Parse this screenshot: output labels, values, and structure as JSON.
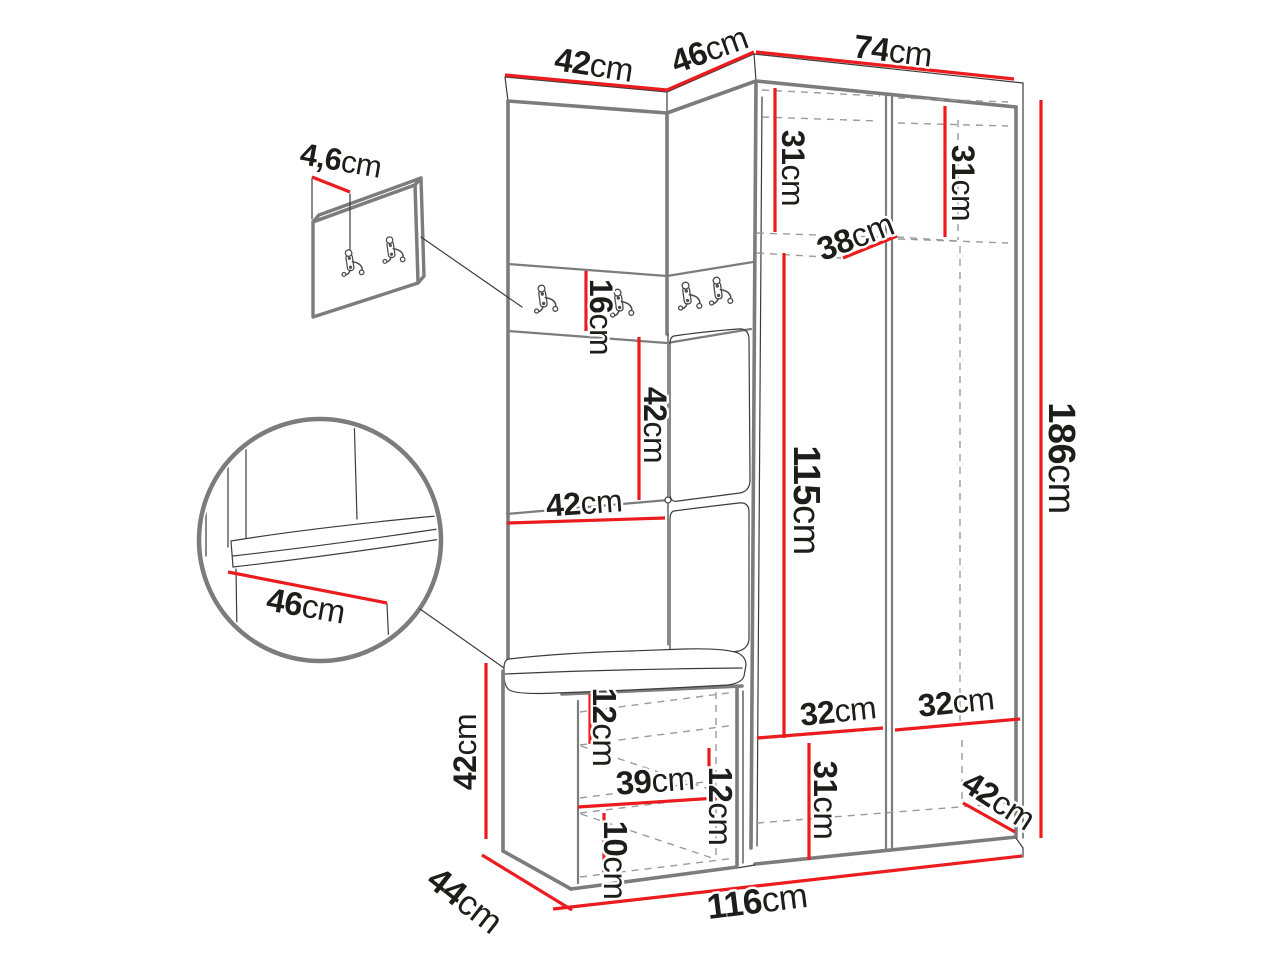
{
  "page": {
    "background": "#ffffff"
  },
  "diagram": {
    "kind": "furniture-dimension-drawing",
    "subject": "corner hallway wardrobe set with coat hooks, upholstered bench and wall hook panel",
    "unit": "cm",
    "colors": {
      "dimension": "#ec1b1e",
      "outline": "#7c7c7c",
      "detail": "#3c3c3c",
      "label": "#1d1d1b",
      "background": "#ffffff"
    },
    "dimensions": [
      {
        "id": "top-width-left",
        "value": "42",
        "unit": "cm",
        "line": {
          "x1": 505,
          "y1": 75,
          "x2": 667,
          "y2": 90
        },
        "label": {
          "x": 594,
          "y": 64,
          "rotate": 9,
          "size": 33
        }
      },
      {
        "id": "top-width-corner",
        "value": "46",
        "unit": "cm",
        "line": {
          "x1": 667,
          "y1": 90,
          "x2": 754,
          "y2": 52
        },
        "label": {
          "x": 709,
          "y": 49,
          "rotate": -20,
          "size": 33
        }
      },
      {
        "id": "top-width-right",
        "value": "74",
        "unit": "cm",
        "line": {
          "x1": 756,
          "y1": 52,
          "x2": 1014,
          "y2": 79
        },
        "label": {
          "x": 893,
          "y": 50,
          "rotate": 7,
          "size": 33
        }
      },
      {
        "id": "inner-height-top-left",
        "value": "31",
        "unit": "cm",
        "line": {
          "x1": 775,
          "y1": 88,
          "x2": 775,
          "y2": 232
        },
        "label": {
          "x": 793,
          "y": 168,
          "rotate": 90,
          "size": 32
        }
      },
      {
        "id": "inner-height-top-right",
        "value": "31",
        "unit": "cm",
        "line": {
          "x1": 945,
          "y1": 106,
          "x2": 945,
          "y2": 237
        },
        "label": {
          "x": 963,
          "y": 183,
          "rotate": 90,
          "size": 32
        }
      },
      {
        "id": "inner-depth-top",
        "value": "38",
        "unit": "cm",
        "line": {
          "x1": 843,
          "y1": 258,
          "x2": 897,
          "y2": 236
        },
        "label": {
          "x": 855,
          "y": 236,
          "rotate": -21,
          "size": 33
        }
      },
      {
        "id": "total-height",
        "value": "186",
        "unit": "cm",
        "line": {
          "x1": 1041,
          "y1": 100,
          "x2": 1041,
          "y2": 838
        },
        "label": {
          "x": 1061,
          "y": 458,
          "rotate": 90,
          "size": 38
        }
      },
      {
        "id": "hook-strip-height",
        "value": "16",
        "unit": "cm",
        "line": {
          "x1": 586,
          "y1": 271,
          "x2": 586,
          "y2": 331
        },
        "label": {
          "x": 601,
          "y": 317,
          "rotate": 90,
          "size": 32
        }
      },
      {
        "id": "niche-height",
        "value": "42",
        "unit": "cm",
        "line": {
          "x1": 639,
          "y1": 337,
          "x2": 639,
          "y2": 500
        },
        "label": {
          "x": 655,
          "y": 425,
          "rotate": 90,
          "size": 32
        }
      },
      {
        "id": "niche-width",
        "value": "42",
        "unit": "cm",
        "line": {
          "x1": 507,
          "y1": 523,
          "x2": 665,
          "y2": 518
        },
        "label": {
          "x": 584,
          "y": 503,
          "rotate": -4,
          "size": 32
        }
      },
      {
        "id": "tall-inner-height",
        "value": "115",
        "unit": "cm",
        "line": {
          "x1": 784,
          "y1": 253,
          "x2": 784,
          "y2": 738
        },
        "label": {
          "x": 806,
          "y": 500,
          "rotate": 90,
          "size": 38
        }
      },
      {
        "id": "seat-depth-detail",
        "value": "46",
        "unit": "cm",
        "line": {
          "x1": 228,
          "y1": 572,
          "x2": 387,
          "y2": 603
        },
        "label": {
          "x": 306,
          "y": 605,
          "rotate": 10,
          "size": 33
        }
      },
      {
        "id": "panel-depth",
        "value": "4,6",
        "unit": "cm",
        "line": {
          "x1": 312,
          "y1": 177,
          "x2": 350,
          "y2": 192
        },
        "label": {
          "x": 341,
          "y": 160,
          "rotate": 10,
          "size": 31
        }
      },
      {
        "id": "bench-height",
        "value": "42",
        "unit": "cm",
        "line": {
          "x1": 486,
          "y1": 663,
          "x2": 486,
          "y2": 839
        },
        "label": {
          "x": 465,
          "y": 752,
          "rotate": -90,
          "size": 32
        }
      },
      {
        "id": "bench-top-gap",
        "value": "12",
        "unit": "cm",
        "line": {
          "x1": 590,
          "y1": 694,
          "x2": 590,
          "y2": 744
        },
        "label": {
          "x": 605,
          "y": 727,
          "rotate": 90,
          "size": 33
        }
      },
      {
        "id": "bench-inner-width",
        "value": "39",
        "unit": "cm",
        "line": {
          "x1": 578,
          "y1": 807,
          "x2": 717,
          "y2": 798
        },
        "label": {
          "x": 655,
          "y": 780,
          "rotate": -4,
          "size": 33
        }
      },
      {
        "id": "bench-shelf-gap",
        "value": "12",
        "unit": "cm",
        "line": {
          "x1": 709,
          "y1": 748,
          "x2": 709,
          "y2": 798
        },
        "label": {
          "x": 721,
          "y": 806,
          "rotate": 90,
          "size": 33
        }
      },
      {
        "id": "bench-lower-gap",
        "value": "10",
        "unit": "cm",
        "line": {
          "x1": 604,
          "y1": 813,
          "x2": 604,
          "y2": 878
        },
        "label": {
          "x": 616,
          "y": 860,
          "rotate": 90,
          "size": 33
        }
      },
      {
        "id": "bench-depth",
        "value": "44",
        "unit": "cm",
        "line": {
          "x1": 482,
          "y1": 855,
          "x2": 572,
          "y2": 910
        },
        "label": {
          "x": 465,
          "y": 900,
          "rotate": 38,
          "size": 35
        }
      },
      {
        "id": "total-width",
        "value": "116",
        "unit": "cm",
        "line": {
          "x1": 553,
          "y1": 909,
          "x2": 1022,
          "y2": 856
        },
        "label": {
          "x": 757,
          "y": 901,
          "rotate": -7,
          "size": 35
        }
      },
      {
        "id": "shelf-width-left-door",
        "value": "32",
        "unit": "cm",
        "line": {
          "x1": 757,
          "y1": 738,
          "x2": 883,
          "y2": 728
        },
        "label": {
          "x": 838,
          "y": 711,
          "rotate": -6,
          "size": 32
        }
      },
      {
        "id": "shelf-width-right-door",
        "value": "32",
        "unit": "cm",
        "line": {
          "x1": 895,
          "y1": 730,
          "x2": 1020,
          "y2": 719
        },
        "label": {
          "x": 956,
          "y": 702,
          "rotate": -6,
          "size": 32
        }
      },
      {
        "id": "bottom-inner-height",
        "value": "31",
        "unit": "cm",
        "line": {
          "x1": 809,
          "y1": 743,
          "x2": 809,
          "y2": 860
        },
        "label": {
          "x": 826,
          "y": 800,
          "rotate": 90,
          "size": 33
        }
      },
      {
        "id": "bottom-depth-right",
        "value": "42",
        "unit": "cm",
        "line": {
          "x1": 963,
          "y1": 803,
          "x2": 1015,
          "y2": 832
        },
        "label": {
          "x": 999,
          "y": 800,
          "rotate": 33,
          "size": 33
        }
      }
    ]
  }
}
